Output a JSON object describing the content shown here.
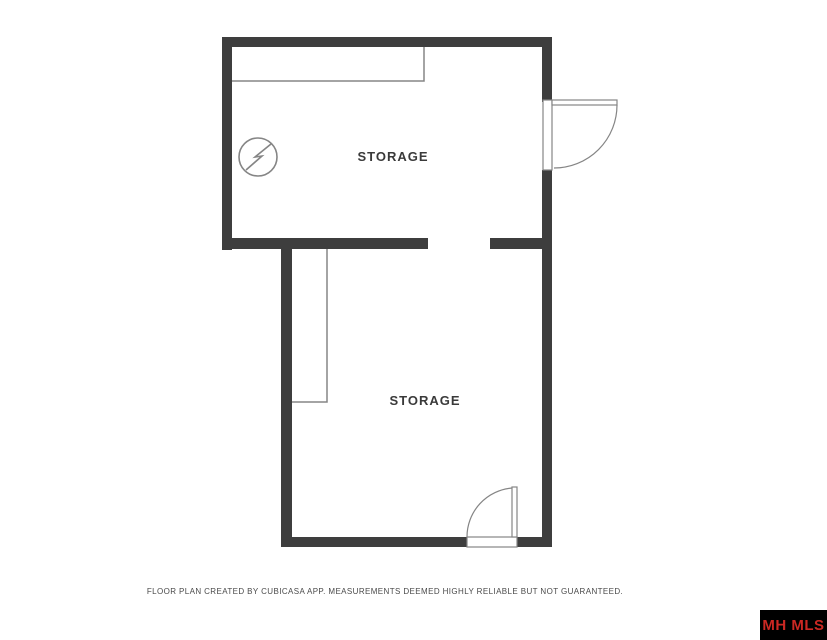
{
  "plan": {
    "rooms": [
      {
        "id": "storage-top",
        "label": "STORAGE"
      },
      {
        "id": "storage-bottom",
        "label": "STORAGE"
      }
    ],
    "symbols": [
      {
        "name": "electrical-switch-icon"
      }
    ]
  },
  "footer": {
    "disclaimer": "FLOOR PLAN CREATED BY CUBICASA APP. MEASUREMENTS DEEMED HIGHLY RELIABLE BUT NOT GUARANTEED."
  },
  "branding": {
    "label": "MH MLS"
  },
  "colors": {
    "wall": "#3e3e3e",
    "line": "#858585",
    "door_fill": "#ffffff",
    "badge_background": "#000000",
    "badge_text": "#cc2823",
    "label_text": "#3a3a3a",
    "background": "#ffffff"
  }
}
